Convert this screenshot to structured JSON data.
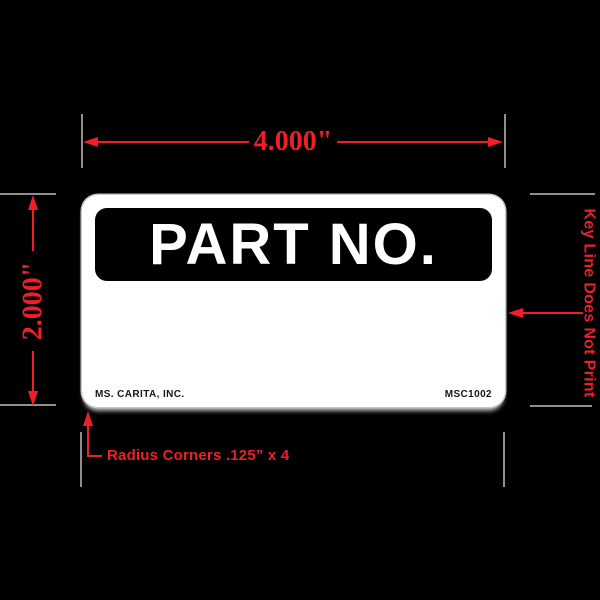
{
  "colors": {
    "page_bg": "#000000",
    "accent_red": "#ED2027",
    "extension_gray": "#8F8F8F",
    "label_bg": "#FFFFFF",
    "band_bg": "#000000"
  },
  "label": {
    "header": "PART NO.",
    "footer_left": "MS. CARITA, INC.",
    "footer_right": "MSC1002"
  },
  "dimensions": {
    "width": "4.000\"",
    "height": "2.000\""
  },
  "annotations": {
    "keyline": "Key Line Does Not Print",
    "radius_corners": "Radius Corners .125” x 4"
  },
  "icons": {
    "dimension_arrowheads": "red triangle arrowheads on dimension and leader lines"
  }
}
